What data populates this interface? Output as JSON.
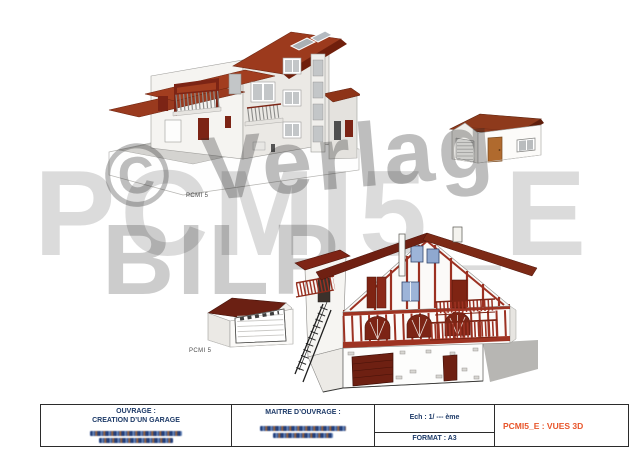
{
  "document": {
    "background": "#ffffff",
    "sheet_type": "architectural 3D views sheet"
  },
  "views": {
    "main_house_label": "PCMI 5",
    "garage_view_label": "PCMI 5"
  },
  "watermark": {
    "copyright": "© Verlag",
    "primary": "PCMI5_E",
    "secondary": "BILP"
  },
  "title_block": {
    "ouvrage_label": "OUVRAGE :",
    "ouvrage_value": "CREATION D’UN GARAGE",
    "maitre_ouvrage_label": "MAITRE D’OUVRAGE :",
    "scale": "Ech : 1/ --- ème",
    "format": "FORMAT : A3",
    "sheet_title": "PCMI5_E : VUES 3D"
  },
  "colors": {
    "sheet_title_orange": "#e8552a",
    "title_navy": "#1d3a68",
    "house_roof_red": "#9a3a1e",
    "basque_roof_dark_red": "#6e2012",
    "timber_red": "#9c3122",
    "window_blue": "#9db4d8",
    "watermark_gray": "#c9c9c9"
  }
}
